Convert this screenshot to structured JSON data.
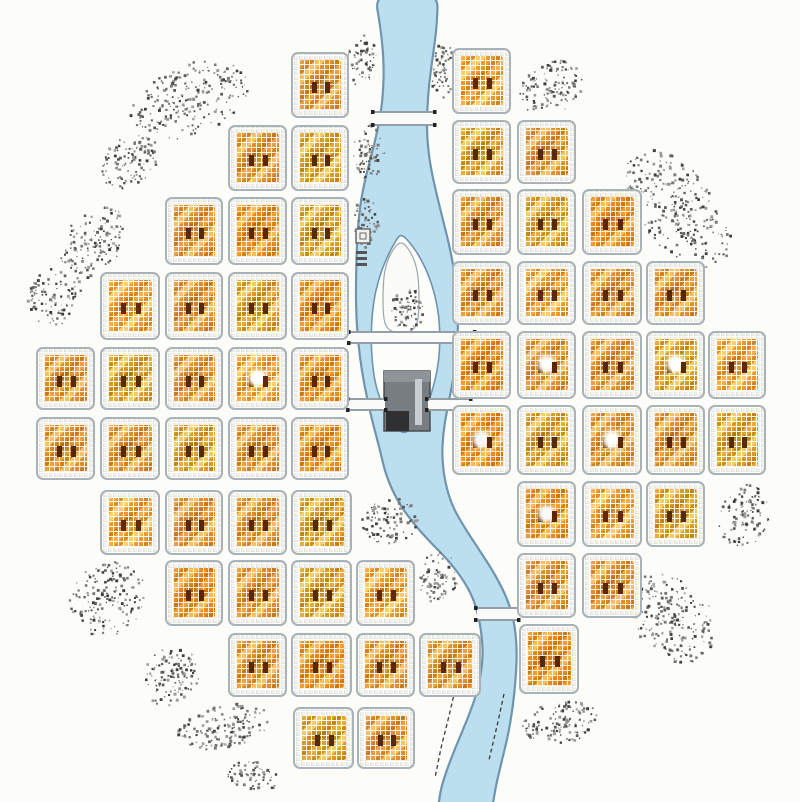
{
  "meta": {
    "description": "Hand-drawn plan of a circular gridded city bisected by a meandering river with a fortified island",
    "canvas": {
      "width": 800,
      "height": 802
    }
  },
  "palette": {
    "background": "#fcfcf9",
    "river_fill": "#bcdff0",
    "river_stroke": "#6f94ae",
    "island_fill": "#fdfdfa",
    "block_border": "#a9b2b6",
    "block_orange_1": "#e9a143",
    "block_orange_2": "#d1841e",
    "block_orange_3": "#f3c168",
    "block_orange_4": "#dd8f2f",
    "block_center_mark": "#57280a",
    "bridge_fill": "#fbfbf9",
    "bridge_stroke": "#86909a",
    "tree_colors": [
      "#3f3f3f",
      "#5c5c5c",
      "#787878",
      "#9a9a9a"
    ],
    "building_gray": "#787d81",
    "building_dark": "#2e3032"
  },
  "map": {
    "blocks_format": [
      "x",
      "y",
      "w",
      "h",
      "highlight"
    ],
    "blocks": [
      [
        291,
        52,
        58,
        66,
        0
      ],
      [
        228,
        125,
        59,
        66,
        0
      ],
      [
        291,
        125,
        58,
        66,
        0
      ],
      [
        165,
        197,
        58,
        68,
        0
      ],
      [
        228,
        197,
        59,
        68,
        0
      ],
      [
        291,
        197,
        58,
        68,
        0
      ],
      [
        100,
        272,
        60,
        68,
        0
      ],
      [
        165,
        272,
        58,
        68,
        0
      ],
      [
        228,
        272,
        59,
        68,
        0
      ],
      [
        291,
        272,
        58,
        68,
        0
      ],
      [
        36,
        347,
        59,
        63,
        0
      ],
      [
        100,
        347,
        60,
        63,
        0
      ],
      [
        165,
        347,
        58,
        63,
        0
      ],
      [
        228,
        347,
        59,
        63,
        1
      ],
      [
        291,
        347,
        58,
        63,
        0
      ],
      [
        36,
        417,
        59,
        63,
        0
      ],
      [
        100,
        417,
        60,
        63,
        0
      ],
      [
        165,
        417,
        58,
        63,
        0
      ],
      [
        228,
        417,
        59,
        63,
        0
      ],
      [
        291,
        417,
        58,
        63,
        0
      ],
      [
        100,
        490,
        60,
        65,
        0
      ],
      [
        165,
        490,
        58,
        65,
        0
      ],
      [
        228,
        490,
        59,
        65,
        0
      ],
      [
        291,
        490,
        61,
        65,
        0
      ],
      [
        165,
        560,
        58,
        66,
        0
      ],
      [
        228,
        560,
        59,
        66,
        0
      ],
      [
        291,
        560,
        61,
        66,
        0
      ],
      [
        356,
        560,
        59,
        66,
        0
      ],
      [
        228,
        633,
        59,
        64,
        0
      ],
      [
        291,
        633,
        61,
        64,
        0
      ],
      [
        356,
        633,
        59,
        64,
        0
      ],
      [
        419,
        633,
        62,
        64,
        0
      ],
      [
        293,
        707,
        61,
        62,
        0
      ],
      [
        357,
        707,
        58,
        62,
        0
      ],
      [
        452,
        48,
        59,
        66,
        0
      ],
      [
        452,
        120,
        59,
        64,
        0
      ],
      [
        517,
        120,
        59,
        64,
        0
      ],
      [
        452,
        189,
        59,
        66,
        0
      ],
      [
        517,
        189,
        59,
        66,
        0
      ],
      [
        582,
        189,
        60,
        66,
        0
      ],
      [
        452,
        261,
        59,
        64,
        0
      ],
      [
        517,
        261,
        59,
        64,
        0
      ],
      [
        582,
        261,
        60,
        64,
        0
      ],
      [
        646,
        261,
        59,
        64,
        0
      ],
      [
        452,
        331,
        59,
        68,
        0
      ],
      [
        517,
        331,
        59,
        68,
        1
      ],
      [
        582,
        331,
        60,
        68,
        0
      ],
      [
        646,
        331,
        59,
        68,
        1
      ],
      [
        708,
        331,
        58,
        68,
        0
      ],
      [
        452,
        405,
        59,
        70,
        1
      ],
      [
        517,
        405,
        59,
        70,
        0
      ],
      [
        582,
        405,
        60,
        70,
        1
      ],
      [
        646,
        405,
        59,
        70,
        0
      ],
      [
        708,
        405,
        58,
        70,
        0
      ],
      [
        517,
        481,
        59,
        66,
        1
      ],
      [
        582,
        481,
        60,
        66,
        0
      ],
      [
        646,
        481,
        59,
        66,
        0
      ],
      [
        517,
        553,
        59,
        65,
        0
      ],
      [
        582,
        553,
        60,
        65,
        0
      ],
      [
        519,
        624,
        60,
        70,
        0
      ]
    ],
    "river": {
      "west_bank": [
        [
          374,
          -10
        ],
        [
          381,
          30
        ],
        [
          384,
          65
        ],
        [
          383,
          95
        ],
        [
          380,
          118
        ],
        [
          374,
          146
        ],
        [
          366,
          175
        ],
        [
          360,
          205
        ],
        [
          357,
          240
        ],
        [
          356,
          275
        ],
        [
          356,
          310
        ],
        [
          358,
          342
        ],
        [
          362,
          372
        ],
        [
          367,
          398
        ],
        [
          373,
          424
        ],
        [
          380,
          450
        ],
        [
          386,
          476
        ],
        [
          398,
          502
        ],
        [
          413,
          523
        ],
        [
          431,
          543
        ],
        [
          449,
          561
        ],
        [
          464,
          581
        ],
        [
          473,
          598
        ],
        [
          478,
          614
        ],
        [
          482,
          636
        ],
        [
          483,
          660
        ],
        [
          478,
          690
        ],
        [
          468,
          718
        ],
        [
          456,
          746
        ],
        [
          446,
          772
        ],
        [
          440,
          792
        ],
        [
          438,
          812
        ]
      ],
      "east_bank": [
        [
          492,
          812
        ],
        [
          495,
          790
        ],
        [
          501,
          764
        ],
        [
          508,
          736
        ],
        [
          513,
          706
        ],
        [
          516,
          676
        ],
        [
          517,
          648
        ],
        [
          514,
          620
        ],
        [
          507,
          598
        ],
        [
          496,
          576
        ],
        [
          482,
          554
        ],
        [
          466,
          530
        ],
        [
          452,
          506
        ],
        [
          445,
          482
        ],
        [
          442,
          458
        ],
        [
          443,
          434
        ],
        [
          447,
          410
        ],
        [
          452,
          386
        ],
        [
          456,
          360
        ],
        [
          458,
          332
        ],
        [
          458,
          304
        ],
        [
          455,
          276
        ],
        [
          450,
          248
        ],
        [
          443,
          220
        ],
        [
          436,
          192
        ],
        [
          430,
          164
        ],
        [
          427,
          138
        ],
        [
          427,
          112
        ],
        [
          429,
          84
        ],
        [
          433,
          55
        ],
        [
          437,
          25
        ],
        [
          438,
          -10
        ]
      ],
      "dashed_bank_lines": [
        [
          [
            455,
            690
          ],
          [
            449,
            716
          ],
          [
            441,
            748
          ],
          [
            435,
            778
          ]
        ],
        [
          [
            504,
            694
          ],
          [
            497,
            726
          ],
          [
            489,
            760
          ]
        ]
      ]
    },
    "island": {
      "outline": [
        [
          401,
          233
        ],
        [
          412,
          245
        ],
        [
          421,
          259
        ],
        [
          429,
          276
        ],
        [
          435,
          295
        ],
        [
          439,
          316
        ],
        [
          440,
          338
        ],
        [
          439,
          360
        ],
        [
          435,
          381
        ],
        [
          429,
          401
        ],
        [
          421,
          417
        ],
        [
          412,
          428
        ],
        [
          404,
          434
        ],
        [
          396,
          428
        ],
        [
          388,
          417
        ],
        [
          381,
          402
        ],
        [
          375,
          383
        ],
        [
          372,
          361
        ],
        [
          371,
          338
        ],
        [
          372,
          315
        ],
        [
          375,
          293
        ],
        [
          381,
          272
        ],
        [
          388,
          255
        ],
        [
          395,
          242
        ]
      ],
      "bastion": [
        [
          401,
          240
        ],
        [
          411,
          252
        ],
        [
          417,
          268
        ],
        [
          419,
          286
        ],
        [
          419,
          316
        ],
        [
          415,
          330
        ],
        [
          401,
          334
        ],
        [
          387,
          330
        ],
        [
          383,
          316
        ],
        [
          383,
          286
        ],
        [
          385,
          268
        ],
        [
          391,
          252
        ]
      ],
      "building_parts": [
        {
          "x": 384,
          "y": 371,
          "w": 46,
          "h": 60,
          "fill": "#787d81",
          "stroke": "#42464a"
        },
        {
          "x": 384,
          "y": 371,
          "w": 46,
          "h": 11,
          "fill": "#8f9498",
          "stroke": ""
        },
        {
          "x": 386,
          "y": 411,
          "w": 23,
          "h": 20,
          "fill": "#2e3032",
          "stroke": ""
        },
        {
          "x": 415,
          "y": 379,
          "w": 7,
          "h": 46,
          "fill": "#c9cdd1",
          "stroke": ""
        }
      ]
    },
    "bridges_format": [
      "x",
      "y",
      "w",
      "h"
    ],
    "bridges": [
      [
        374,
        111,
        60,
        15
      ],
      [
        350,
        331,
        124,
        13
      ],
      [
        349,
        398,
        36,
        13
      ],
      [
        428,
        398,
        42,
        13
      ],
      [
        477,
        607,
        41,
        14
      ]
    ],
    "trees_format": [
      "cx",
      "cy",
      "rx",
      "ry",
      "rot_deg",
      "dots"
    ],
    "tree_clusters": [
      [
        190,
        100,
        62,
        35,
        -22,
        230
      ],
      [
        130,
        162,
        32,
        24,
        -40,
        110
      ],
      [
        93,
        242,
        40,
        28,
        -55,
        140
      ],
      [
        55,
        297,
        30,
        26,
        -60,
        100
      ],
      [
        362,
        60,
        15,
        26,
        8,
        65
      ],
      [
        369,
        152,
        16,
        27,
        2,
        70
      ],
      [
        367,
        222,
        13,
        26,
        0,
        60
      ],
      [
        443,
        70,
        12,
        28,
        4,
        65
      ],
      [
        551,
        88,
        33,
        26,
        -28,
        120
      ],
      [
        678,
        210,
        72,
        38,
        52,
        270
      ],
      [
        744,
        516,
        25,
        32,
        12,
        105
      ],
      [
        673,
        618,
        50,
        38,
        55,
        210
      ],
      [
        438,
        578,
        20,
        26,
        5,
        80
      ],
      [
        562,
        722,
        40,
        21,
        -8,
        120
      ],
      [
        390,
        522,
        29,
        23,
        -18,
        95
      ],
      [
        108,
        598,
        40,
        36,
        -45,
        160
      ],
      [
        172,
        676,
        32,
        27,
        -50,
        120
      ],
      [
        224,
        727,
        48,
        21,
        -12,
        140
      ],
      [
        254,
        776,
        28,
        14,
        8,
        65
      ],
      [
        408,
        309,
        17,
        21,
        0,
        65
      ]
    ],
    "symbols": {
      "legend_square": {
        "x": 356,
        "y": 229,
        "size": 14,
        "inner_size": 6
      },
      "legend_marks": {
        "x": 356,
        "w": 11,
        "ys": [
          251,
          257,
          263
        ],
        "h": 3
      }
    }
  }
}
